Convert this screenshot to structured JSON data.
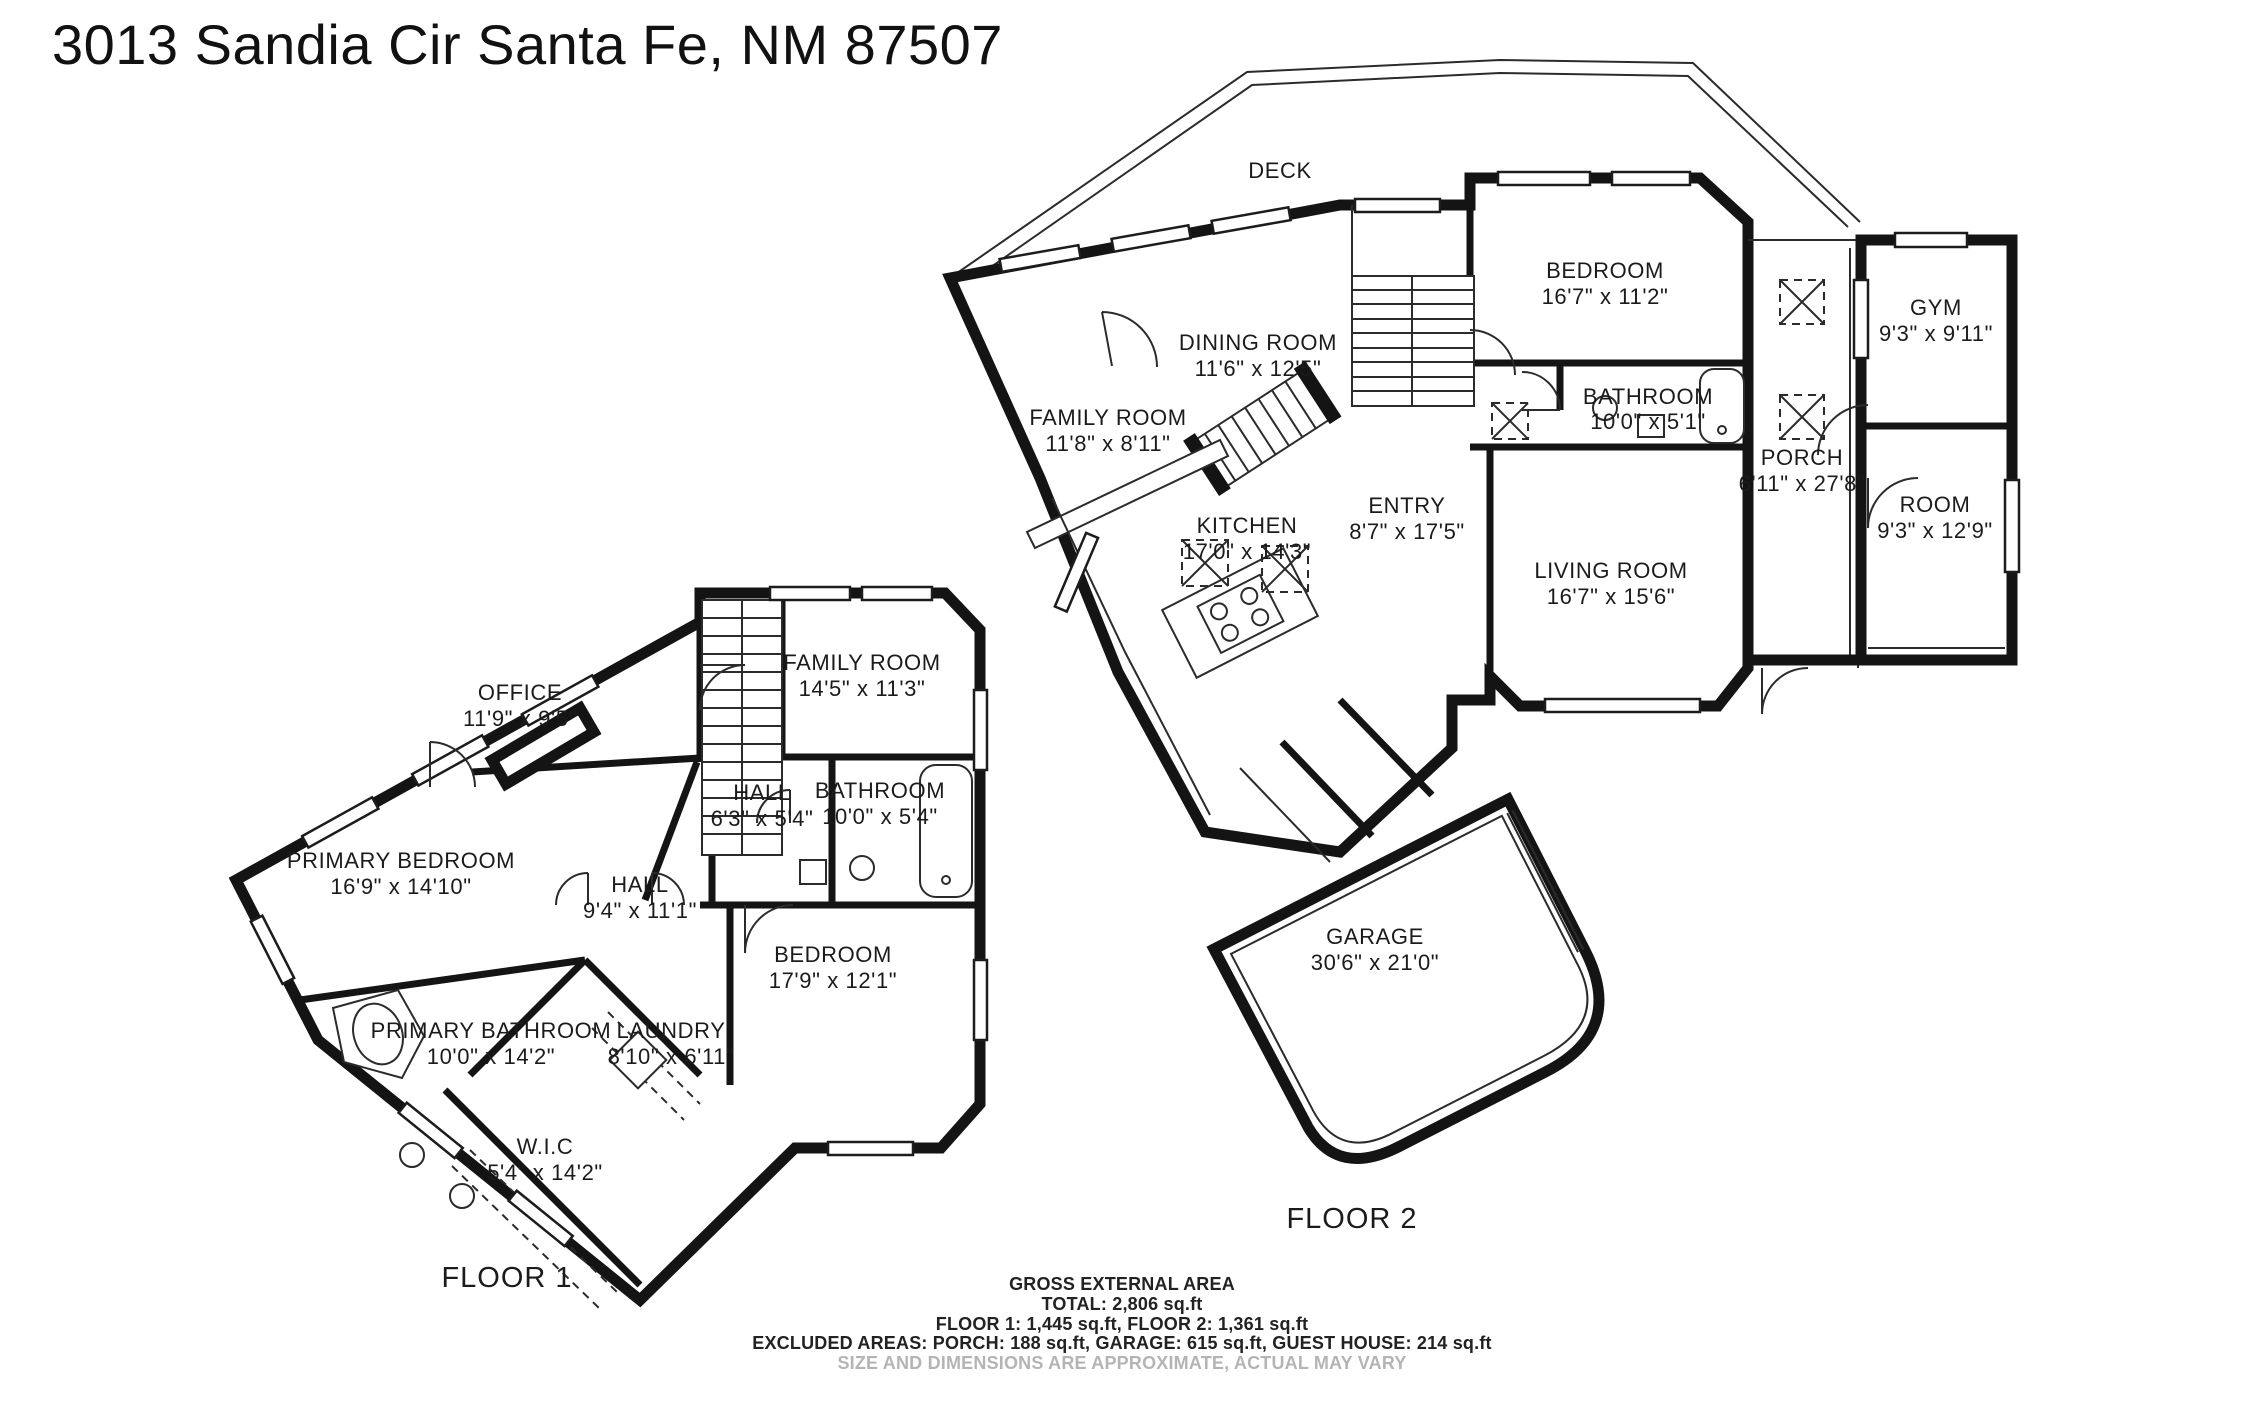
{
  "title": "3013 Sandia Cir Santa Fe, NM 87507",
  "floor1": {
    "label": "FLOOR 1",
    "rooms": {
      "office": {
        "name": "OFFICE",
        "dims": "11'9\" x 9'5\""
      },
      "primary_bedroom": {
        "name": "PRIMARY BEDROOM",
        "dims": "16'9\" x 14'10\""
      },
      "family_room": {
        "name": "FAMILY ROOM",
        "dims": "14'5\" x 11'3\""
      },
      "hall_small": {
        "name": "HALL",
        "dims": "6'3\" x 5'4\""
      },
      "hall": {
        "name": "HALL",
        "dims": "9'4\" x 11'1\""
      },
      "bathroom": {
        "name": "BATHROOM",
        "dims": "10'0\" x 5'4\""
      },
      "bedroom": {
        "name": "BEDROOM",
        "dims": "17'9\" x 12'1\""
      },
      "laundry": {
        "name": "LAUNDRY",
        "dims": "8'10\" x 6'11\""
      },
      "primary_bathroom": {
        "name": "PRIMARY BATHROOM",
        "dims": "10'0\" x 14'2\""
      },
      "wic": {
        "name": "W.I.C",
        "dims": "5'4\" x 14'2\""
      }
    }
  },
  "floor2": {
    "label": "FLOOR 2",
    "rooms": {
      "deck": {
        "name": "DECK",
        "dims": ""
      },
      "family_room": {
        "name": "FAMILY ROOM",
        "dims": "11'8\" x 8'11\""
      },
      "dining_room": {
        "name": "DINING ROOM",
        "dims": "11'6\" x 12'5\""
      },
      "kitchen": {
        "name": "KITCHEN",
        "dims": "17'0\" x 14'3\""
      },
      "entry": {
        "name": "ENTRY",
        "dims": "8'7\" x 17'5\""
      },
      "bedroom": {
        "name": "BEDROOM",
        "dims": "16'7\" x 11'2\""
      },
      "bathroom": {
        "name": "BATHROOM",
        "dims": "10'0\" x 5'1\""
      },
      "living_room": {
        "name": "LIVING ROOM",
        "dims": "16'7\" x 15'6\""
      },
      "porch": {
        "name": "PORCH",
        "dims": "6'11\" x 27'8\""
      },
      "gym": {
        "name": "GYM",
        "dims": "9'3\" x 9'11\""
      },
      "room": {
        "name": "ROOM",
        "dims": "9'3\" x 12'9\""
      },
      "garage": {
        "name": "GARAGE",
        "dims": "30'6\" x 21'0\""
      }
    }
  },
  "footer": {
    "line1": "GROSS EXTERNAL AREA",
    "line2": "TOTAL: 2,806 sq.ft",
    "line3": "FLOOR 1: 1,445 sq.ft, FLOOR 2: 1,361 sq.ft",
    "line4": "EXCLUDED AREAS: PORCH: 188 sq.ft, GARAGE: 615 sq.ft, GUEST HOUSE: 214 sq.ft",
    "line5": "SIZE AND DIMENSIONS ARE APPROXIMATE, ACTUAL MAY VARY"
  }
}
